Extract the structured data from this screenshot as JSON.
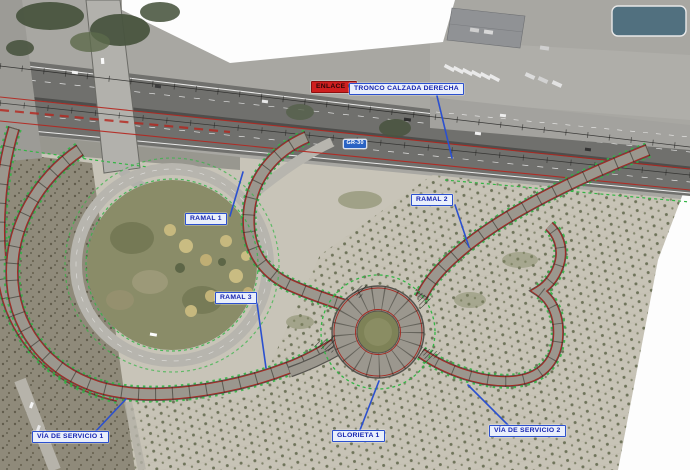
{
  "annotations": {
    "enlace": {
      "text": "ENLACE 6"
    },
    "tronco": {
      "text": "TRONCO CALZADA DERECHA"
    },
    "road_shield": {
      "text": "GR-30"
    },
    "ramal1": {
      "text": "RAMAL 1"
    },
    "ramal2": {
      "text": "RAMAL 2"
    },
    "ramal3": {
      "text": "RAMAL 3"
    },
    "glorieta1": {
      "text": "GLORIETA 1"
    },
    "via_servicio1": {
      "text": "VÍA DE SERVICIO 1"
    },
    "via_servicio2": {
      "text": "VÍA DE SERVICIO 2"
    }
  },
  "colors": {
    "label_border": "#2b50cf",
    "label_fill": "#e9effc",
    "label_text": "#1423b0",
    "enlace_fill": "#cf1f1f",
    "leader_blue": "#2b50cf",
    "boundary_green": "#33b545",
    "alignment_red": "#b5251d",
    "new_road_gray": "#9b978e",
    "shield_blue": "#2a63c4"
  }
}
